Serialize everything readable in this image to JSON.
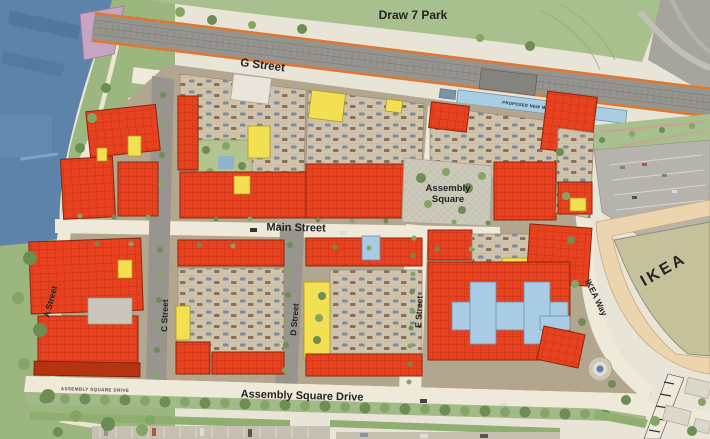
{
  "labels": {
    "regions": {
      "draw7_park": "Draw 7 Park",
      "assembly_square": [
        "Assembly",
        "Square"
      ],
      "ikea": "IKEA",
      "mbta_platform": "PROPOSED NEW MBTA PLATFORM"
    },
    "streets": {
      "g_street": "G Street",
      "main_street": "Main Street",
      "assembly_square_drive": "Assembly Square Drive",
      "assembly_square_drive_caps": "ASSEMBLY SQUARE DRIVE",
      "a_street": "A Street",
      "c_street": "C Street",
      "d_street": "D Street",
      "e_street": "E Street",
      "ikea_way": "IKEA Way"
    }
  },
  "colors": {
    "water": "#5d83ab",
    "park_green": "#9cb680",
    "draw7_green": "#a8c08d",
    "building_red": "#e8411f",
    "building_yellow": "#f2df52",
    "building_blue": "#a9cbe3",
    "ikea_olive": "#c5c29b",
    "parking_tan": "#cfc3ab",
    "parking_deck_tan": "#ecd4ae",
    "rail_orange": "#e0772e",
    "platform_blue": "#a9cde2",
    "street_light": "#efe9da",
    "asphalt_gray": "#98958e",
    "sidewalk_brown": "#b3a68e"
  }
}
